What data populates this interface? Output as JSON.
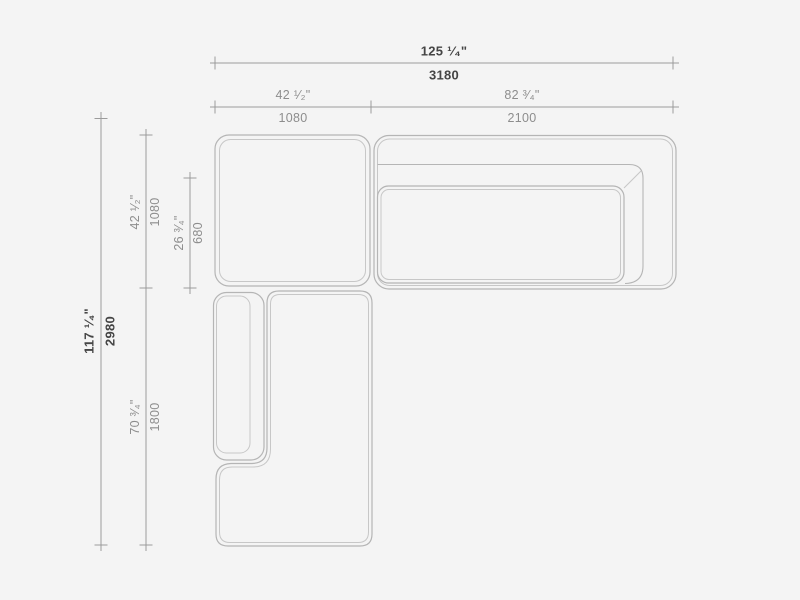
{
  "drawing": {
    "kind": "sectional-sofa-plan-dimension-drawing",
    "colors": {
      "background": "#f4f4f4",
      "furniture_outline": "#b5b5b5",
      "furniture_inner_line": "#c7c7c7",
      "dimension_line": "#9b9b9b",
      "text_primary": "#454545",
      "text_secondary": "#8d8d8d"
    },
    "dimensions": {
      "overall_width": {
        "inches": "125 ¹⁄₄\"",
        "mm": "3180"
      },
      "left_module_width": {
        "inches": "42 ¹⁄₂\"",
        "mm": "1080"
      },
      "right_module_width": {
        "inches": "82 ³⁄₄\"",
        "mm": "2100"
      },
      "overall_depth": {
        "inches": "117 ¹⁄₄\"",
        "mm": "2980"
      },
      "top_module_depth": {
        "inches": "42 ¹⁄₂\"",
        "mm": "1080"
      },
      "seat_depth": {
        "inches": "26 ³⁄₄\"",
        "mm": "680"
      },
      "chaise_length": {
        "inches": "70 ³⁄₄\"",
        "mm": "1800"
      }
    }
  }
}
